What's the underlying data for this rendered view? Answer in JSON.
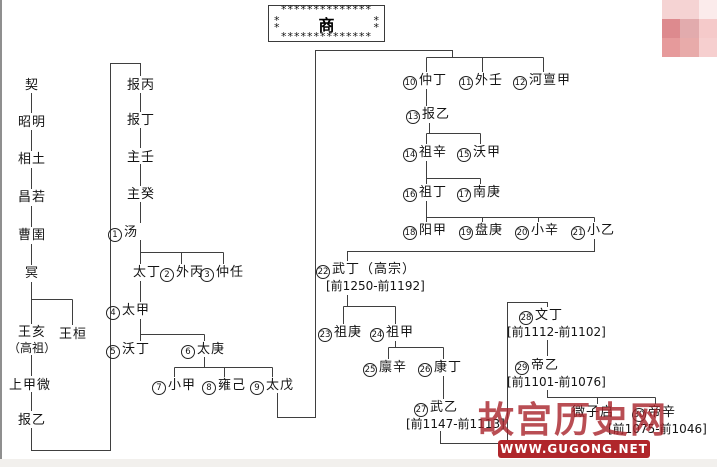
{
  "title": {
    "name": "商",
    "stars_row": "**************",
    "stars_side": "*\n*"
  },
  "nodes": {
    "qi": {
      "name": "契"
    },
    "zhaoming": {
      "name": "昭明"
    },
    "xiangtu": {
      "name": "相土"
    },
    "changruo": {
      "name": "昌若"
    },
    "caoyu": {
      "name": "曹圉"
    },
    "ming": {
      "name": "冥"
    },
    "wanghai": {
      "name": "王亥",
      "name2": "（高祖）"
    },
    "wanghuan": {
      "name": "王桓"
    },
    "shangjiawei": {
      "name": "上甲微"
    },
    "baoyi1": {
      "name": "报乙"
    },
    "baobing": {
      "name": "报丙"
    },
    "baoding": {
      "name": "报丁"
    },
    "zhuren": {
      "name": "主壬"
    },
    "zhugui": {
      "name": "主癸"
    },
    "tang": {
      "num": 1,
      "name": "汤"
    },
    "taiding": {
      "name": "太丁"
    },
    "waibing": {
      "num": 2,
      "name": "外丙"
    },
    "zhongren": {
      "num": 3,
      "name": "仲任"
    },
    "taijia": {
      "num": 4,
      "name": "太甲"
    },
    "woding": {
      "num": 5,
      "name": "沃丁"
    },
    "taigeng": {
      "num": 6,
      "name": "太庚"
    },
    "xiaojia": {
      "num": 7,
      "name": "小甲"
    },
    "yongji": {
      "num": 8,
      "name": "雍己"
    },
    "taiwu": {
      "num": 9,
      "name": "太戊"
    },
    "zhongding": {
      "num": 10,
      "name": "仲丁"
    },
    "wairen": {
      "num": 11,
      "name": "外壬"
    },
    "hedanjia": {
      "num": 12,
      "name": "河亶甲"
    },
    "baoyi2": {
      "num": 13,
      "name": "报乙"
    },
    "zuxin": {
      "num": 14,
      "name": "祖辛"
    },
    "wojia": {
      "num": 15,
      "name": "沃甲"
    },
    "zuding": {
      "num": 16,
      "name": "祖丁"
    },
    "nangeng": {
      "num": 17,
      "name": "南庚"
    },
    "yangjia": {
      "num": 18,
      "name": "阳甲"
    },
    "pangeng": {
      "num": 19,
      "name": "盘庚"
    },
    "xiaoxin": {
      "num": 20,
      "name": "小辛"
    },
    "xiaoyi": {
      "num": 21,
      "name": "小乙"
    },
    "wuding": {
      "num": 22,
      "name": "武丁（高宗）",
      "dates": "[前1250-前1192]"
    },
    "zugeng": {
      "num": 23,
      "name": "祖庚"
    },
    "zujia": {
      "num": 24,
      "name": "祖甲"
    },
    "linxin": {
      "num": 25,
      "name": "廪辛"
    },
    "kangding": {
      "num": 26,
      "name": "康丁"
    },
    "wuyi": {
      "num": 27,
      "name": "武乙",
      "dates": "[前1147-前1113]"
    },
    "wending": {
      "num": 28,
      "name": "文丁",
      "dates": "[前1112-前1102]"
    },
    "diyi": {
      "num": 29,
      "name": "帝乙",
      "dates": "[前1101-前1076]"
    },
    "weiziqi": {
      "name": "微子启"
    },
    "dixin": {
      "num": 30,
      "name": "帝辛",
      "dates": "[前1075-前1046]"
    }
  },
  "watermark": {
    "site_name": "故宫历史网",
    "url_text": "WWW.GUGONG.NET",
    "banner_color": "#b0262b",
    "text_color": "#a8232a"
  },
  "corner_thumbnail": {
    "colors": [
      "#f5d3d3",
      "#f5d3d3",
      "#fbebeb",
      "#dd8a8e",
      "#e2abad",
      "#f5caca",
      "#e69a9b",
      "#e8abaa",
      "#f6cfcf"
    ]
  },
  "line_color": "#3f3f3f"
}
